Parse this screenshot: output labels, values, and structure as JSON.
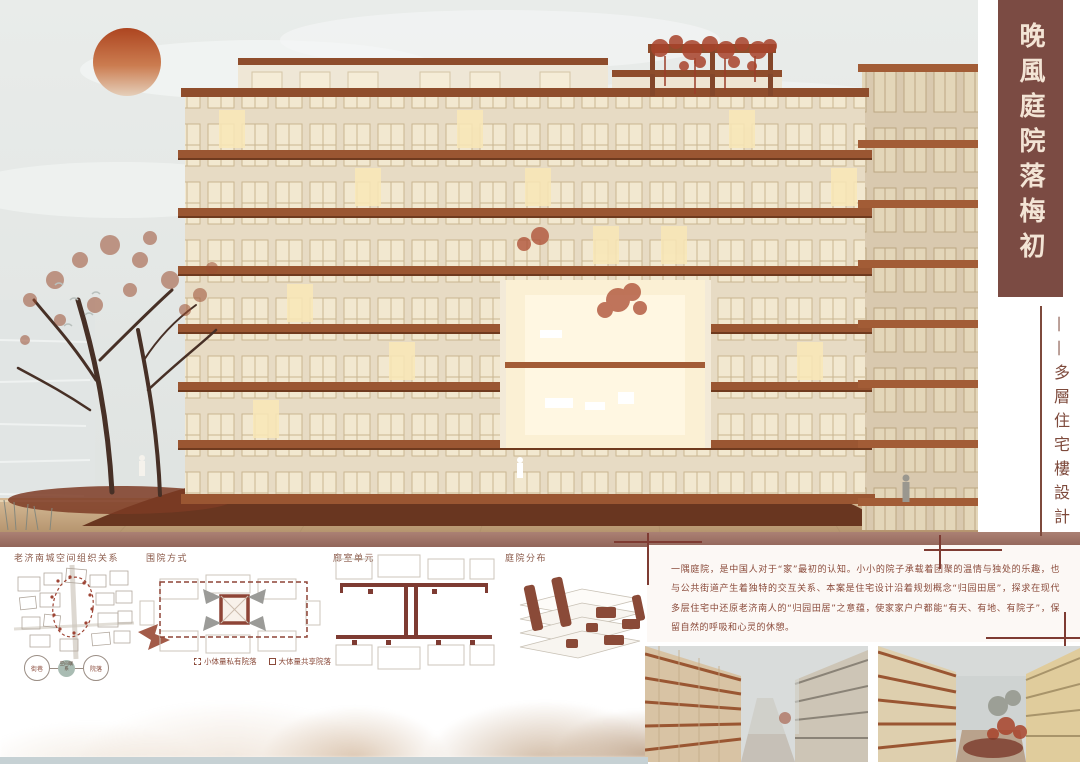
{
  "poster": {
    "title": "晚風庭院落梅初",
    "subtitle": "——多層住宅樓設計",
    "description": "一隅庭院，是中国人对于“家”最初的认知。小小的院子承载着团聚的温情与独处的乐趣，也与公共街道产生着独特的交互关系、本案是住宅设计沿着规划概念“归园田居”，探求在现代多层住宅中还原老济南人的“归园田居”之意蕴，使家家户户都能“有天、有地、有院子”，保留自然的呼吸和心灵的休憩。"
  },
  "diagram_labels": {
    "site": "老济南城空间组织关系",
    "enclosure": "围院方式",
    "unit": "廊室单元",
    "distribution": "庭院分布"
  },
  "legend": {
    "private": "小体量私有院落",
    "shared": "大体量共享院落"
  },
  "relation_circles": {
    "left": "街巷",
    "center": "空间联系",
    "right": "院落"
  },
  "colors": {
    "banner": "#7b4b43",
    "accent": "#7e3b32",
    "copper": "#9a5632",
    "title_text": "#f3e4d5"
  }
}
